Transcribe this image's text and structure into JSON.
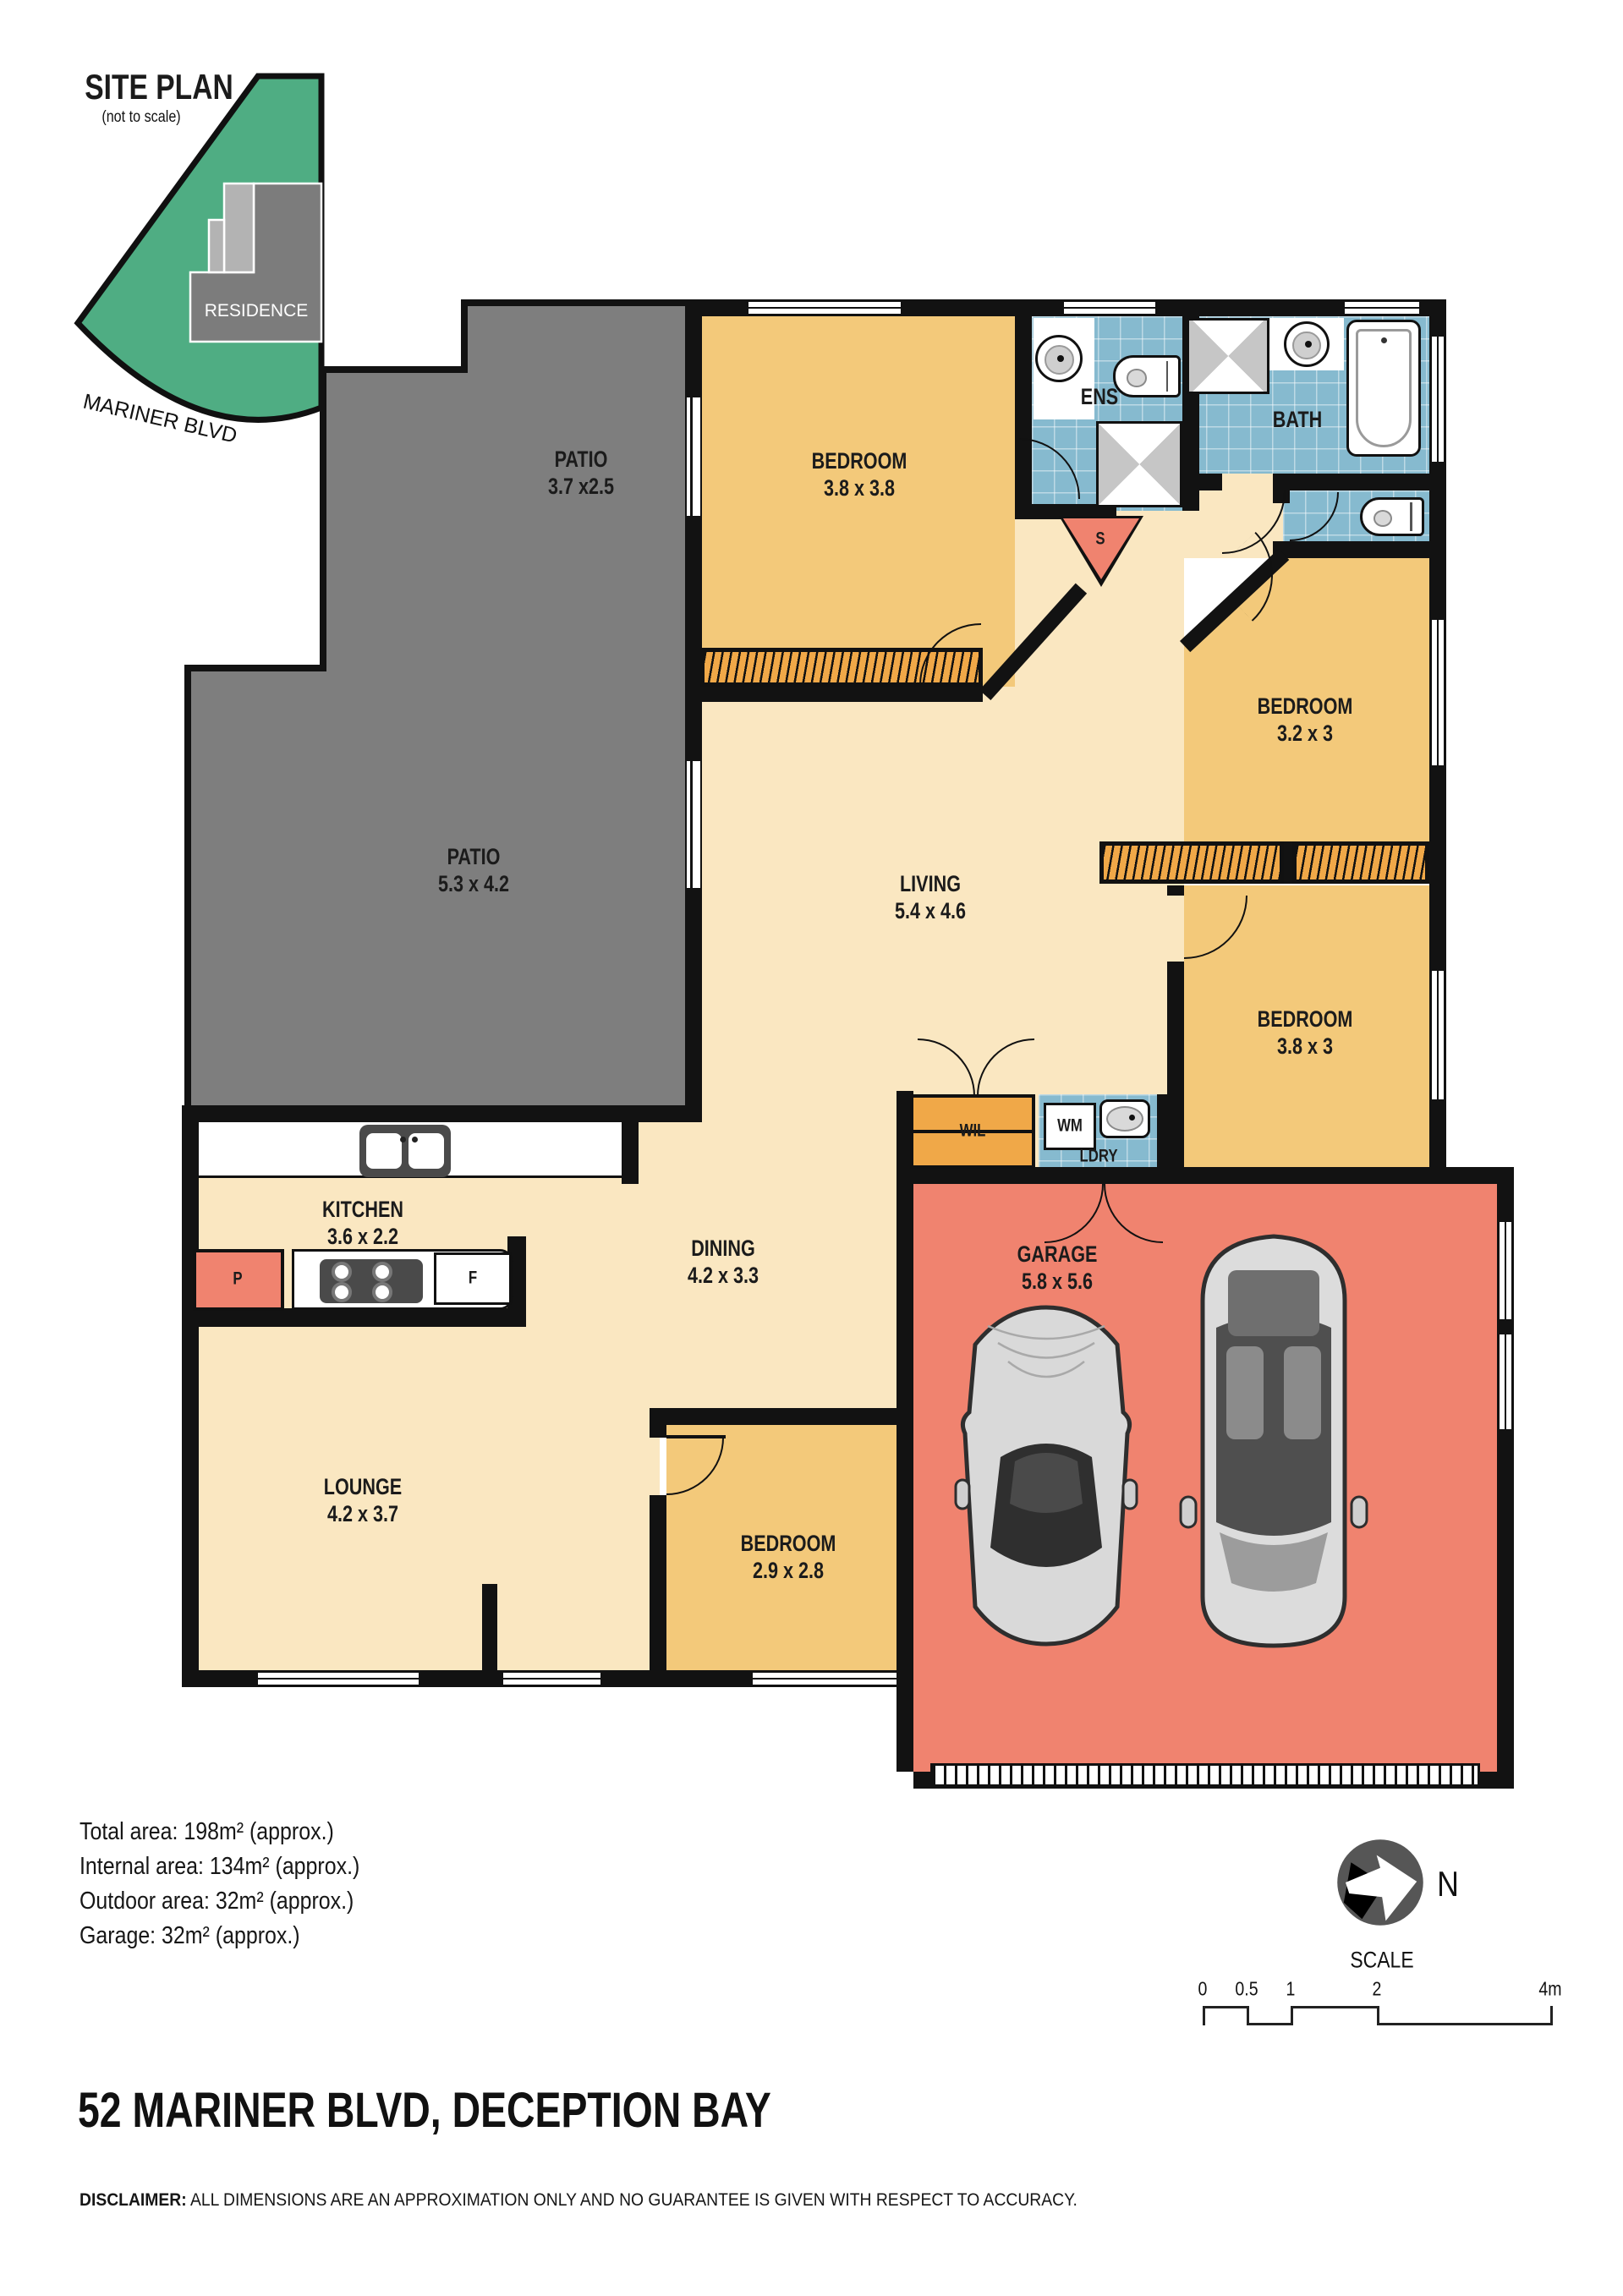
{
  "site_plan": {
    "title": "SITE PLAN",
    "subtitle": "(not to scale)",
    "residence": "RESIDENCE",
    "street": "MARINER BLVD"
  },
  "rooms": {
    "patio_top": {
      "name": "PATIO",
      "dims": "3.7 x2.5"
    },
    "patio_main": {
      "name": "PATIO",
      "dims": "5.3 x 4.2"
    },
    "bedroom_master": {
      "name": "BEDROOM",
      "dims": "3.8 x 3.8"
    },
    "ens": {
      "name": "ENS"
    },
    "bath": {
      "name": "BATH"
    },
    "storage": {
      "name": "S"
    },
    "bedroom2": {
      "name": "BEDROOM",
      "dims": "3.2 x 3"
    },
    "living": {
      "name": "LIVING",
      "dims": "5.4 x 4.6"
    },
    "bedroom3": {
      "name": "BEDROOM",
      "dims": "3.8 x 3"
    },
    "wil": {
      "name": "WIL"
    },
    "wm": {
      "name": "WM"
    },
    "ldry": {
      "name": "LDRY"
    },
    "kitchen": {
      "name": "KITCHEN",
      "dims": "3.6 x 2.2"
    },
    "pantry": {
      "name": "P"
    },
    "fridge": {
      "name": "F"
    },
    "dining": {
      "name": "DINING",
      "dims": "4.2 x 3.3"
    },
    "garage": {
      "name": "GARAGE",
      "dims": "5.8 x 5.6"
    },
    "lounge": {
      "name": "LOUNGE",
      "dims": "4.2 x 3.7"
    },
    "bedroom4": {
      "name": "BEDROOM",
      "dims": "2.9 x 2.8"
    }
  },
  "areas": {
    "line1": "Total area: 198m² (approx.)",
    "line2": "Internal area: 134m² (approx.)",
    "line3": "Outdoor area: 32m² (approx.)",
    "line4": "Garage: 32m² (approx.)"
  },
  "compass": {
    "label": "N"
  },
  "scale_bar": {
    "title": "SCALE",
    "ticks": [
      "0",
      "0.5",
      "1",
      "2",
      "4m"
    ]
  },
  "footer": {
    "address": "52 MARINER BLVD, DECEPTION BAY",
    "disclaimer_label": "DISCLAIMER:",
    "disclaimer_text": " ALL DIMENSIONS ARE AN APPROXIMATION ONLY AND NO GUARANTEE IS GIVEN WITH RESPECT TO ACCURACY."
  },
  "colors": {
    "wall": "#121212",
    "floor_cream": "#FAE7C1",
    "floor_yellow": "#F3C97A",
    "tile_blue": "#86BACF",
    "garage_salmon": "#F0836F",
    "patio_gray": "#7E7E7E",
    "site_green": "#4FAD83",
    "robe_orange": "#F0A848"
  }
}
